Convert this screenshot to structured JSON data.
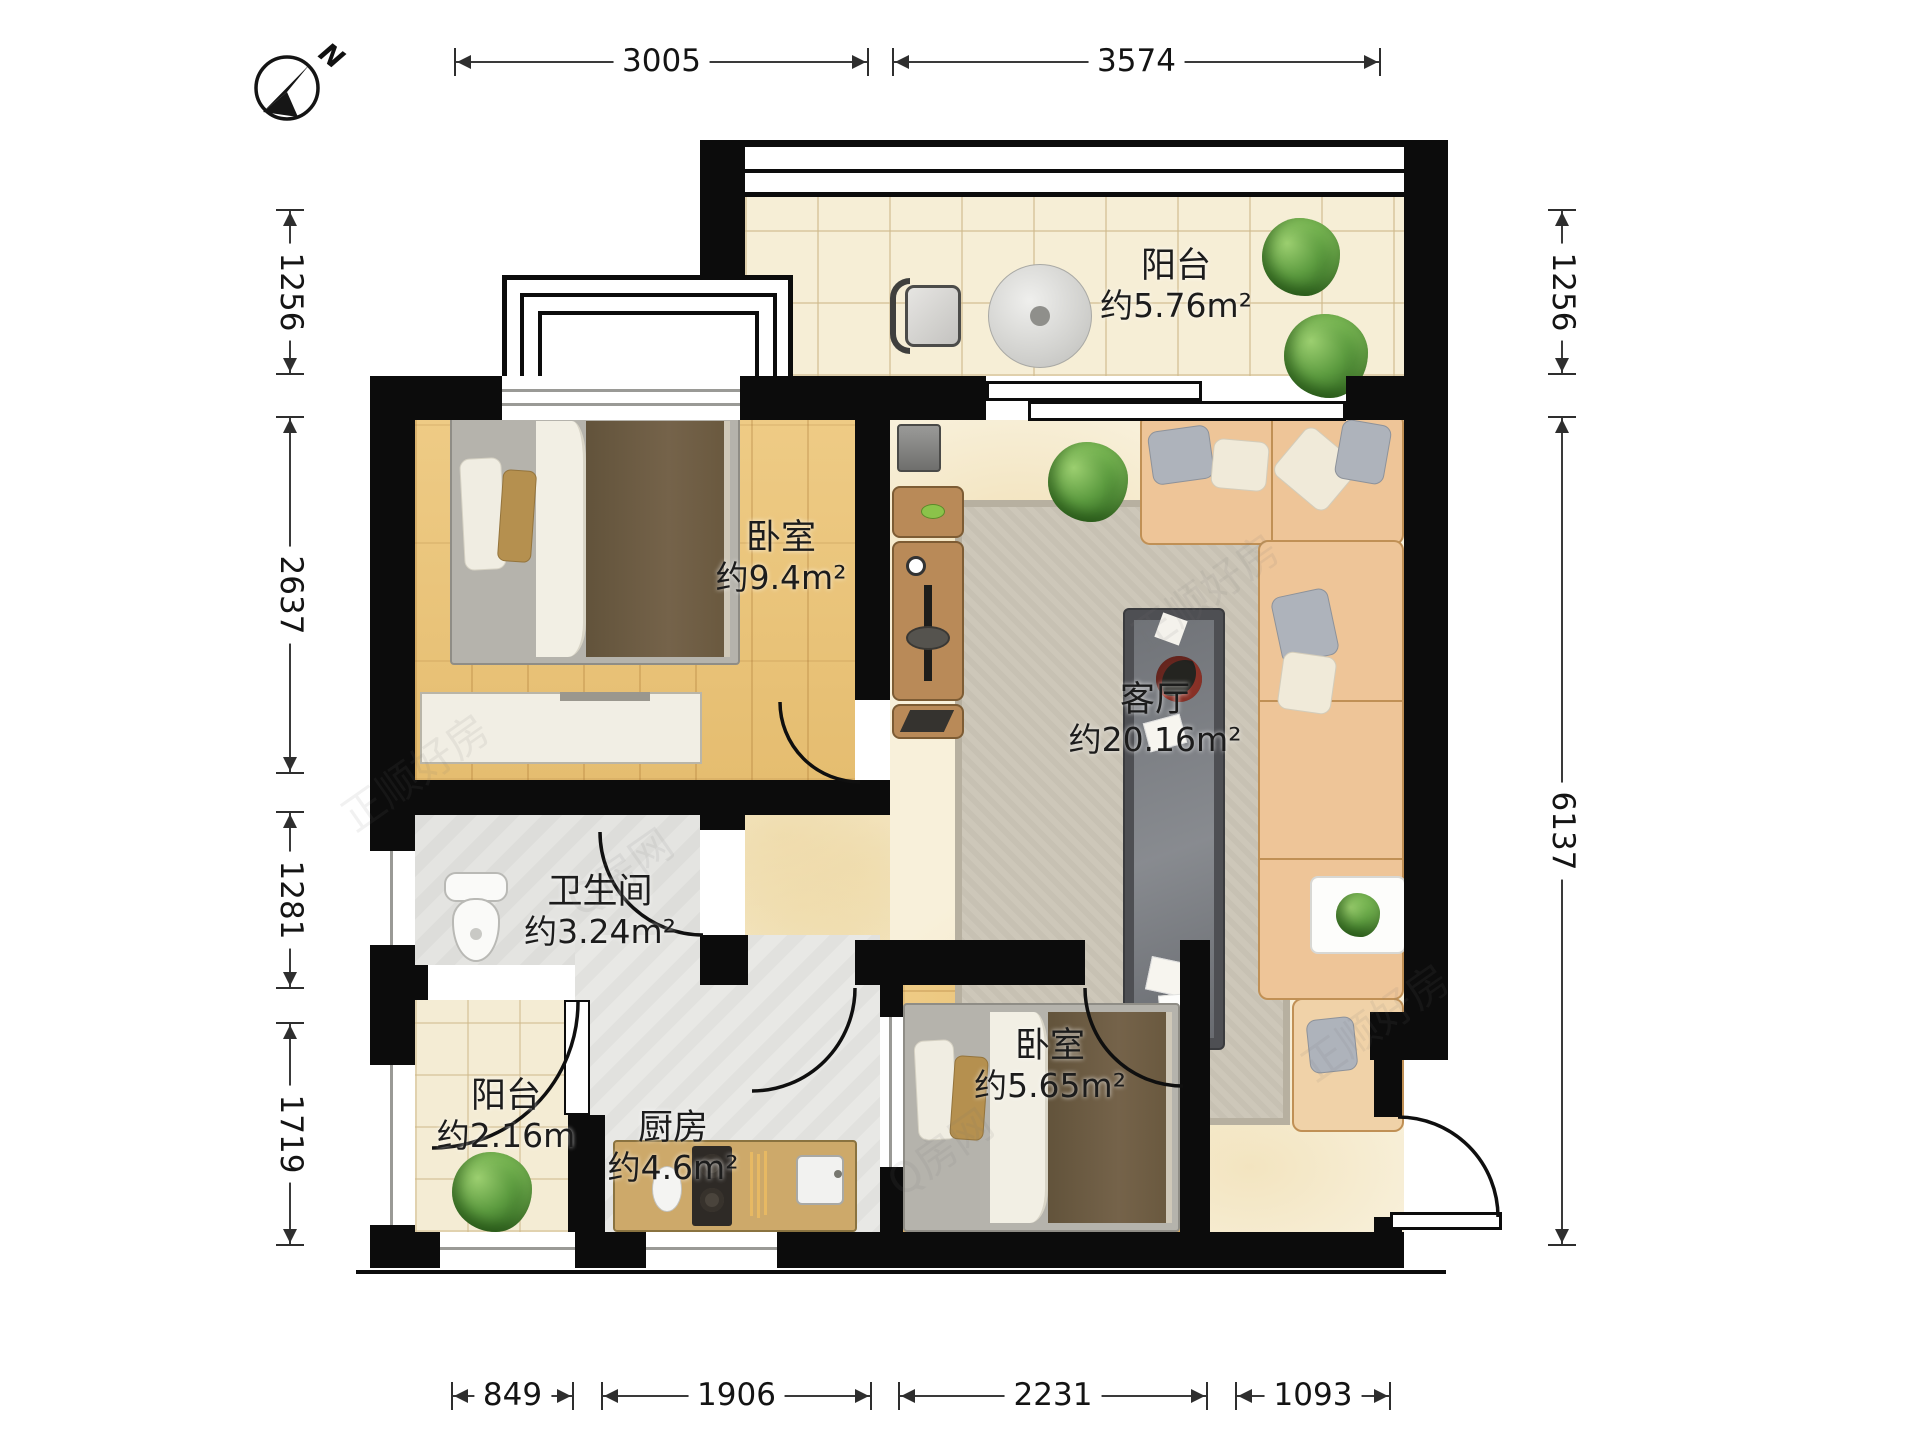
{
  "compass": {
    "north_label": "N"
  },
  "plan": {
    "rooms": [
      {
        "id": "balcony-top",
        "name": "阳台",
        "area": "约5.76m²",
        "cx": 1176,
        "cy": 286
      },
      {
        "id": "bedroom-1",
        "name": "卧室",
        "area": "约9.4m²",
        "cx": 781,
        "cy": 558
      },
      {
        "id": "living-room",
        "name": "客厅",
        "area": "约20.16m²",
        "cx": 1155,
        "cy": 720
      },
      {
        "id": "bathroom",
        "name": "卫生间",
        "area": "约3.24m²",
        "cx": 600,
        "cy": 912
      },
      {
        "id": "balcony-bottom",
        "name": "阳台",
        "area": "约2.16m",
        "cx": 506,
        "cy": 1116
      },
      {
        "id": "kitchen",
        "name": "厨房",
        "area": "约4.6m²",
        "cx": 673,
        "cy": 1148
      },
      {
        "id": "bedroom-2",
        "name": "卧室",
        "area": "约5.65m²",
        "cx": 1050,
        "cy": 1066
      }
    ],
    "dimensions": {
      "top": [
        {
          "value": "3005",
          "x1": 455,
          "x2": 868,
          "y": 62
        },
        {
          "value": "3574",
          "x1": 893,
          "x2": 1380,
          "y": 62
        }
      ],
      "bottom": [
        {
          "value": "849",
          "x1": 452,
          "x2": 573,
          "y": 1396
        },
        {
          "value": "1906",
          "x1": 602,
          "x2": 871,
          "y": 1396
        },
        {
          "value": "2231",
          "x1": 899,
          "x2": 1207,
          "y": 1396
        },
        {
          "value": "1093",
          "x1": 1236,
          "x2": 1390,
          "y": 1396
        }
      ],
      "left": [
        {
          "value": "1256",
          "y1": 210,
          "y2": 374,
          "x": 290
        },
        {
          "value": "2637",
          "y1": 417,
          "y2": 773,
          "x": 290
        },
        {
          "value": "1281",
          "y1": 812,
          "y2": 988,
          "x": 290
        },
        {
          "value": "1719",
          "y1": 1023,
          "y2": 1245,
          "x": 290
        }
      ],
      "right": [
        {
          "value": "1256",
          "y1": 210,
          "y2": 374,
          "x": 1562
        },
        {
          "value": "6137",
          "y1": 417,
          "y2": 1245,
          "x": 1562
        }
      ]
    },
    "watermarks": [
      {
        "text": "正顺好房",
        "x": 330,
        "y": 740,
        "rot": -35
      },
      {
        "text": "Q房网",
        "x": 560,
        "y": 840,
        "rot": -35
      },
      {
        "text": "正顺好房",
        "x": 1120,
        "y": 560,
        "rot": -35
      },
      {
        "text": "Q房网",
        "x": 880,
        "y": 1120,
        "rot": -35
      },
      {
        "text": "正顺好房",
        "x": 1290,
        "y": 990,
        "rot": -35
      }
    ],
    "colors": {
      "wall": "#0c0c0c",
      "wood_floor": "#eac87e",
      "balcony_tile": "#f6eed6",
      "marble_floor": "#f8f0da",
      "gray_tile": "#e4e4e1",
      "sofa": "#eec598",
      "cabinet": "#b98a58",
      "rug": "#cdc7b9",
      "plant": "#5d9c40"
    }
  }
}
